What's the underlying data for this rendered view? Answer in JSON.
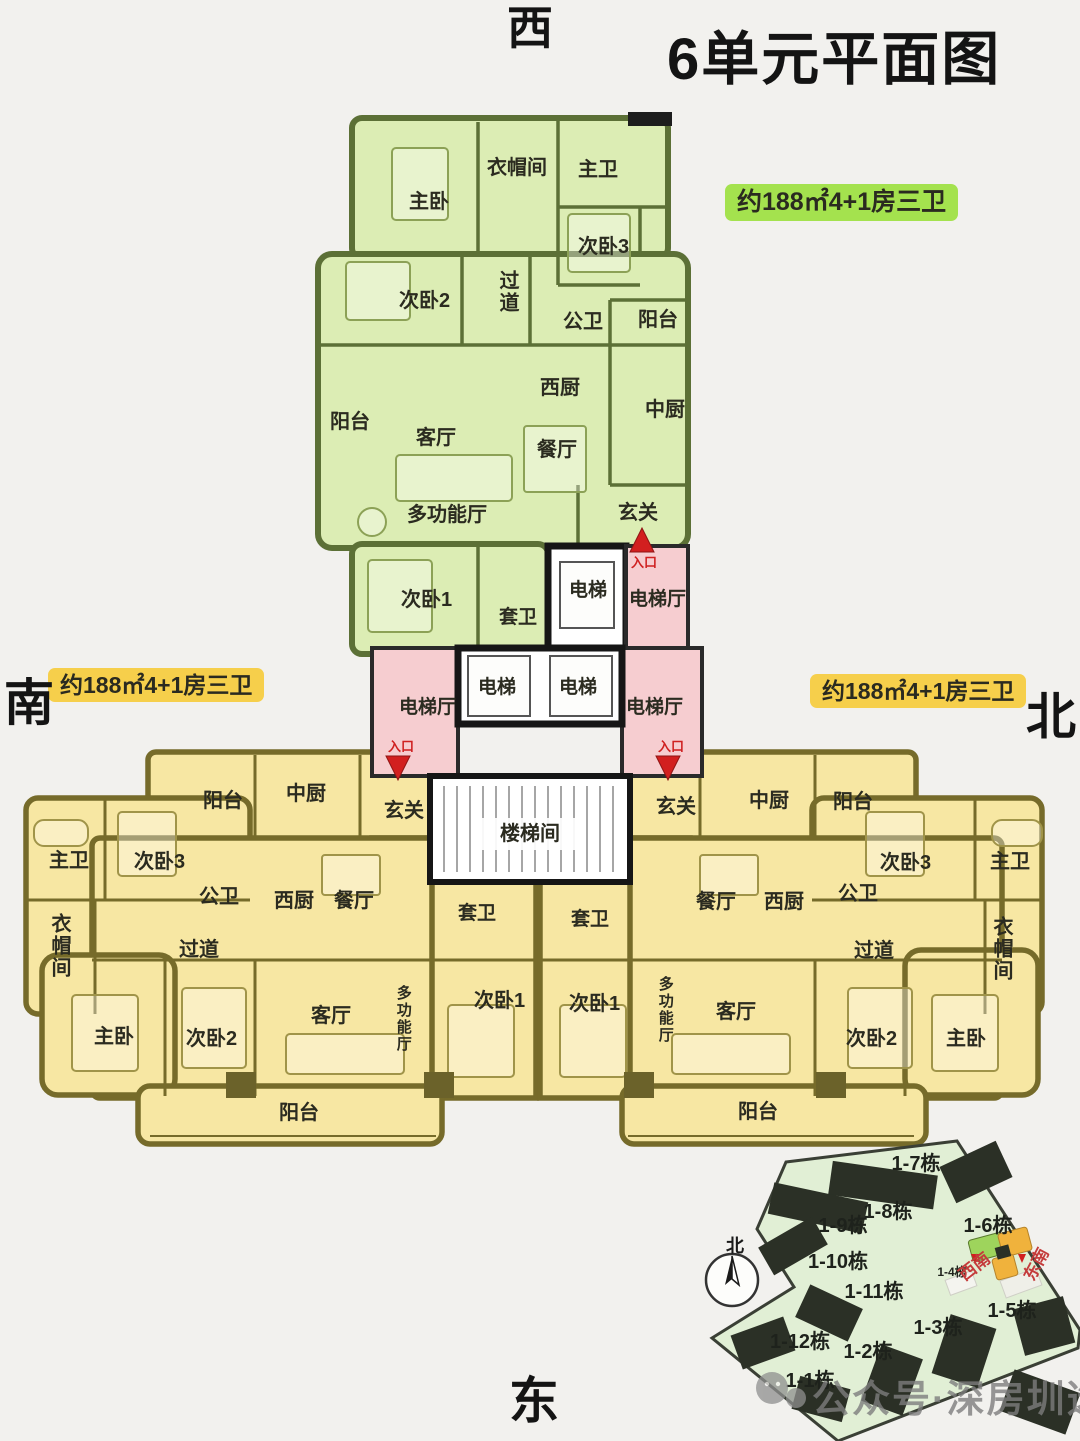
{
  "title": "6单元平面图",
  "directions": {
    "west": "西",
    "south": "南",
    "north": "北",
    "east": "东"
  },
  "area_labels": {
    "green": "约188㎡4+1房三卫",
    "south_wing": "约188㎡4+1房三卫",
    "north_wing": "约188㎡4+1房三卫"
  },
  "green_unit": {
    "rooms": [
      "衣帽间",
      "主卫",
      "主卧",
      "次卧3",
      "次卧2",
      "过道",
      "公卫",
      "阳台",
      "西厨",
      "中厨",
      "阳台",
      "客厅",
      "餐厅",
      "多功能厅",
      "玄关",
      "次卧1",
      "套卫"
    ]
  },
  "core": {
    "elevator": "电梯",
    "elevator_hall": "电梯厅",
    "stairwell": "楼梯间",
    "entrance": "入口"
  },
  "south_unit": {
    "rooms": [
      "阳台",
      "中厨",
      "玄关",
      "主卫",
      "次卧3",
      "公卫",
      "西厨",
      "餐厅",
      "衣帽间",
      "过道",
      "主卧",
      "次卧2",
      "客厅",
      "多功能厅",
      "套卫",
      "次卧1",
      "阳台"
    ]
  },
  "north_unit": {
    "rooms": [
      "玄关",
      "中厨",
      "阳台",
      "次卧3",
      "主卫",
      "公卫",
      "餐厅",
      "西厨",
      "过道",
      "衣帽间",
      "套卫",
      "次卧1",
      "多功能厅",
      "客厅",
      "次卧2",
      "主卧",
      "阳台"
    ]
  },
  "site_map": {
    "compass_north": "北",
    "buildings": [
      "1-7栋",
      "1-8栋",
      "1-9栋",
      "1-10栋",
      "1-11栋",
      "1-12栋",
      "1-1栋",
      "1-2栋",
      "1-3栋",
      "1-5栋",
      "1-6栋",
      "1-4栋"
    ],
    "entry_directions": [
      "西南",
      "东南"
    ]
  },
  "watermark": "公众号·深房圳选",
  "colors": {
    "green_unit": "#dcedb4",
    "yellow_unit": "#f7e7a3",
    "elevator_hall_pink": "#f6cdd0",
    "green_tag_bg": "#a4e24e",
    "yellow_tag_bg": "#f6cf4b",
    "entrance_red": "#d21f1f",
    "site_area": "#e1efd5",
    "building_dark": "#2b3026"
  }
}
